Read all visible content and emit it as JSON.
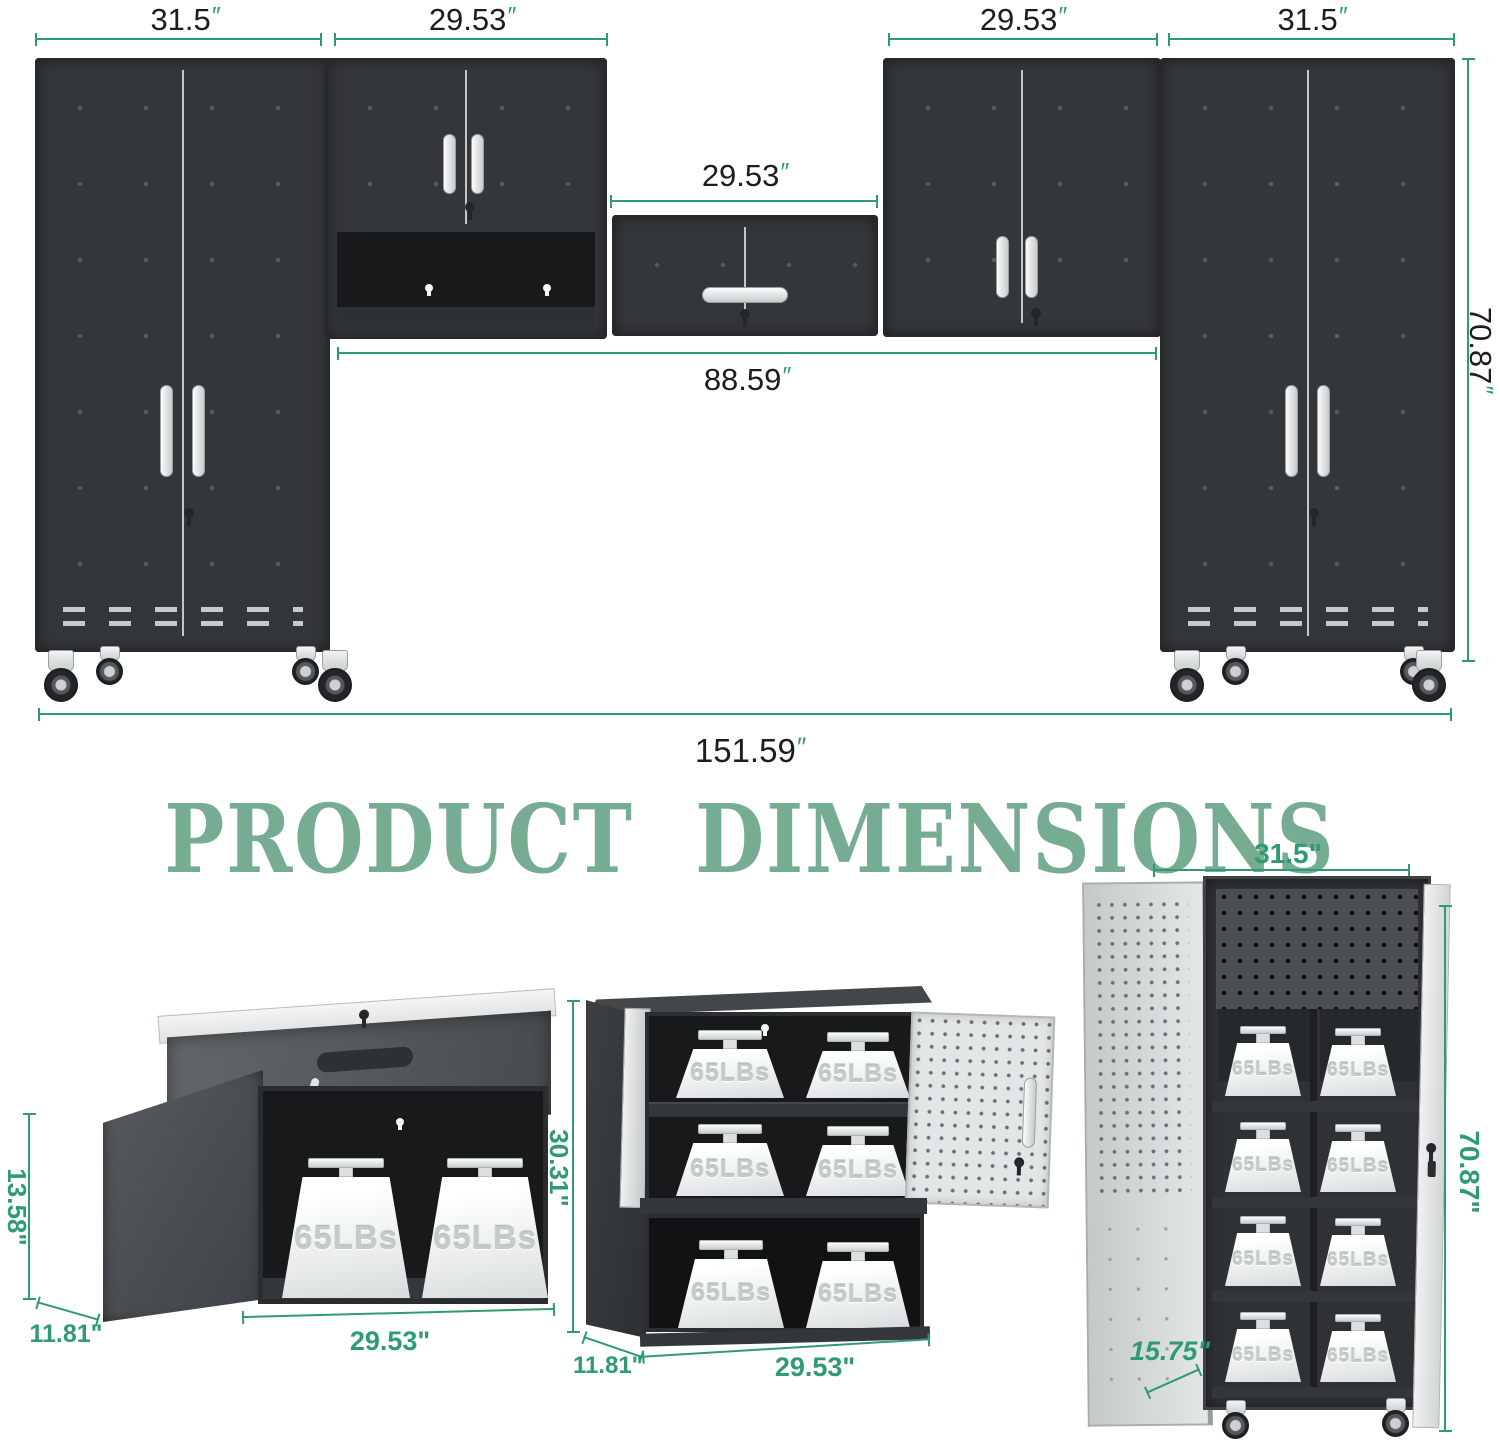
{
  "title": "PRODUCT DIMENSIONS",
  "weight_label": "65LBs",
  "colors": {
    "dimension_green": "#2f9b72",
    "title_green": "#76ac91",
    "frame_dark": "#34373a",
    "door_light": "#eceeee"
  },
  "top_diagram": {
    "left_tall_width": {
      "value": "31.5",
      "unit": "″"
    },
    "wall_cab1_width": {
      "value": "29.53",
      "unit": "″"
    },
    "middle_cab_width": {
      "value": "29.53",
      "unit": "″"
    },
    "wall_cab2_width": {
      "value": "29.53",
      "unit": "″"
    },
    "right_tall_width": {
      "value": "31.5",
      "unit": "″"
    },
    "span_width": {
      "value": "88.59",
      "unit": "″"
    },
    "total_width": {
      "value": "151.59",
      "unit": "″"
    },
    "total_height": {
      "value": "70.87",
      "unit": "″"
    }
  },
  "bottom_views": {
    "flip_top_cabinet": {
      "height": "13.58\"",
      "depth": "11.81\"",
      "width": "29.53\""
    },
    "stacked_cabinet": {
      "height": "30.31\"",
      "depth": "11.81\"",
      "width": "29.53\""
    },
    "tall_cabinet": {
      "width": "31.5\"",
      "height": "70.87\"",
      "depth": "15.75\""
    }
  }
}
